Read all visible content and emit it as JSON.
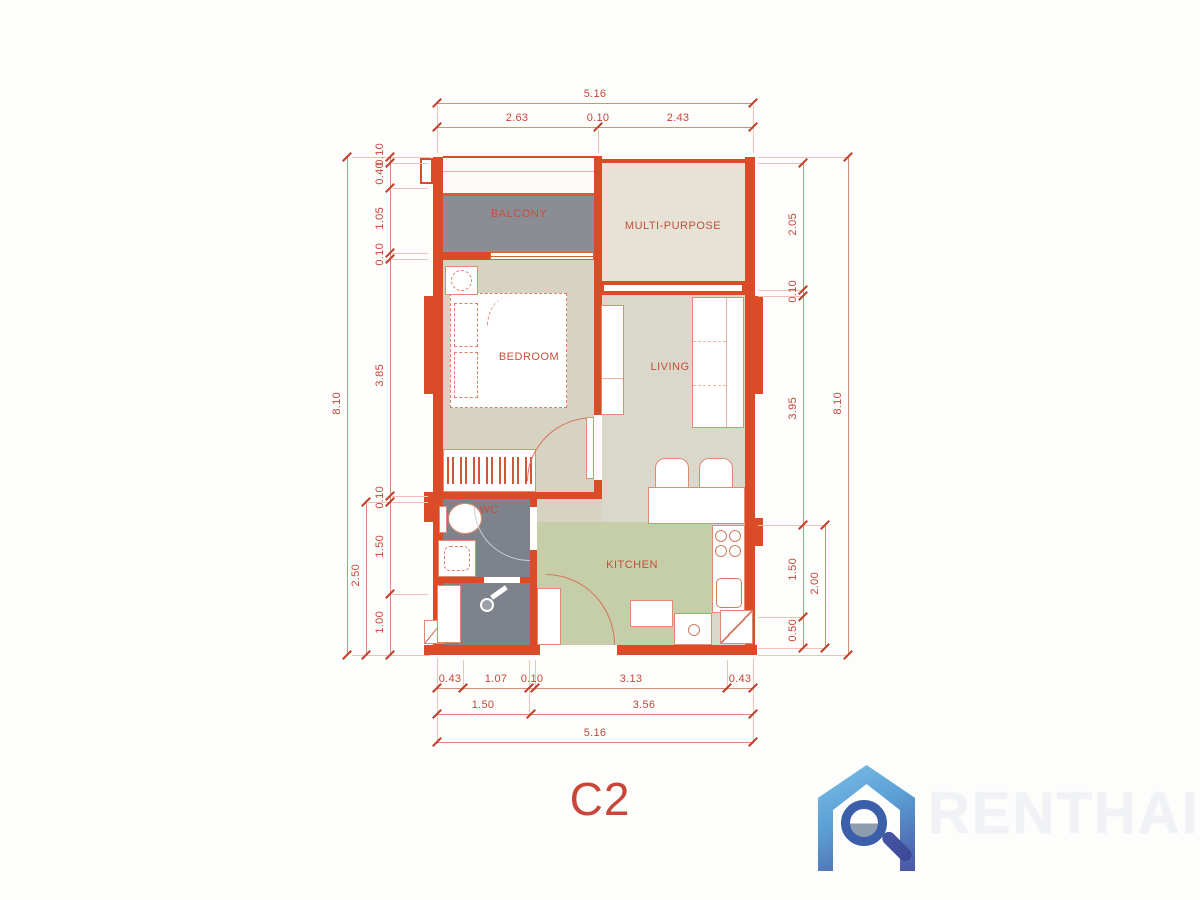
{
  "unit": {
    "label": "C2"
  },
  "rooms": {
    "balcony": "BALCONY",
    "multi_purpose": "MULTI-PURPOSE",
    "bedroom": "BEDROOM",
    "living": "LIVING",
    "wc": "WC",
    "kitchen": "KITCHEN"
  },
  "dimensions": {
    "top": {
      "total": "5.16",
      "segments": [
        "2.63",
        "0.10",
        "2.43"
      ]
    },
    "bottom": {
      "row1": [
        "0.43",
        "1.07",
        "0.10",
        "3.13",
        "0.43"
      ],
      "row2": [
        "1.50",
        "3.56"
      ],
      "total": "5.16"
    },
    "left": {
      "outer_total": "8.10",
      "mid_span": "2.50",
      "inner": [
        "0.10",
        "0.40",
        "1.05",
        "0.10",
        "3.85",
        "0.10",
        "1.50",
        "1.00"
      ]
    },
    "right": {
      "outer_total": "8.10",
      "mid_span": "2.00",
      "inner": [
        "2.05",
        "0.10",
        "3.95",
        "1.50",
        "0.50"
      ]
    }
  },
  "logo": {
    "brand": "RENTHAI"
  },
  "colors": {
    "wall": "#dc4b27",
    "dimension_text": "#c5473a",
    "balcony_floor": "#8a8d94",
    "wc_floor": "#7e838b",
    "bedroom_floor": "#d6d3c3",
    "living_floor": "#dad7cb",
    "multi_purpose_floor": "#e6e2d5",
    "kitchen_floor": "#c6cda9",
    "logo_blue": "#5a9fd4",
    "logo_indigo": "#4b55a3",
    "logo_text": "#f0f2f5"
  }
}
